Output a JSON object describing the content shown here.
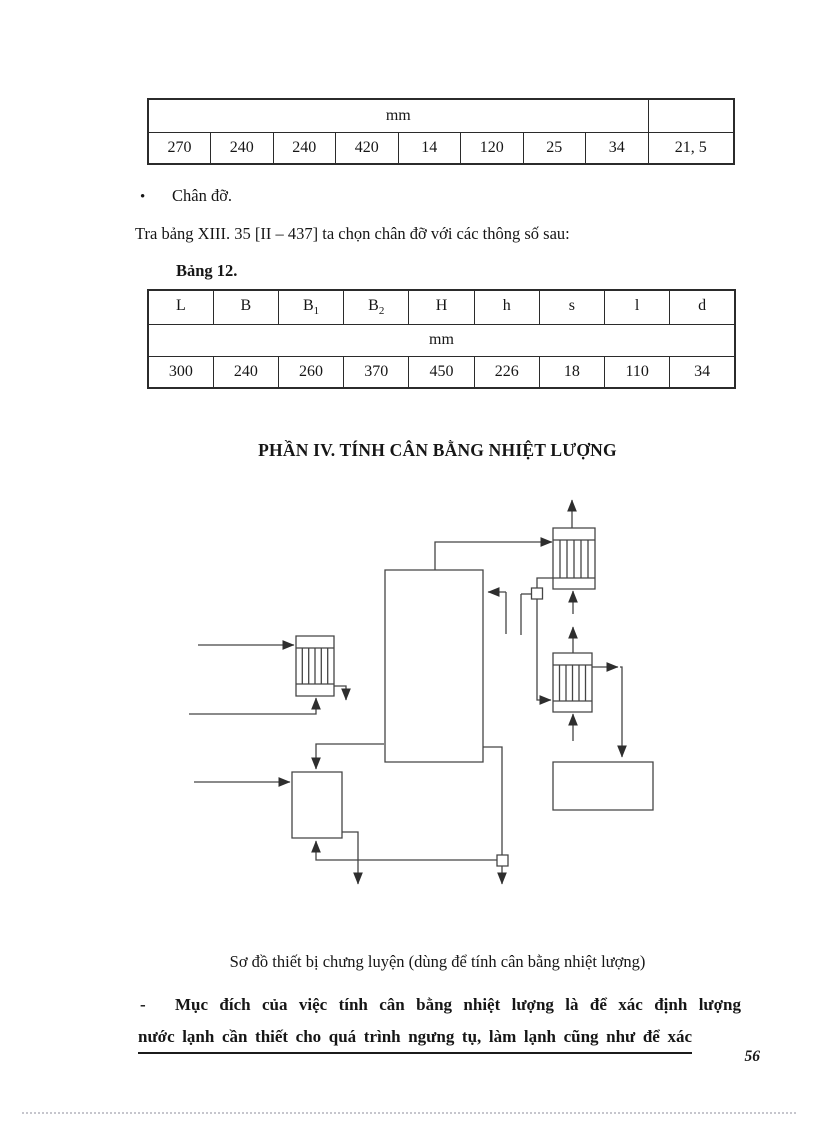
{
  "colors": {
    "ink": "#161616",
    "table_border": "#2b2b2b",
    "diagram_stroke": "#454545"
  },
  "table1": {
    "unit_label": "mm",
    "values": [
      "270",
      "240",
      "240",
      "420",
      "14",
      "120",
      "25",
      "34",
      "21, 5"
    ]
  },
  "bullet": {
    "marker": "•",
    "label": "Chân đỡ."
  },
  "paragraph1": "Tra bảng XIII. 35 [II – 437] ta chọn chân đỡ với các thông số sau:",
  "table2_caption": "Bảng 12.",
  "table2": {
    "headers": [
      {
        "base": "L",
        "sub": ""
      },
      {
        "base": "B",
        "sub": ""
      },
      {
        "base": "B",
        "sub": "1"
      },
      {
        "base": "B",
        "sub": "2"
      },
      {
        "base": "H",
        "sub": ""
      },
      {
        "base": "h",
        "sub": ""
      },
      {
        "base": "s",
        "sub": ""
      },
      {
        "base": "l",
        "sub": ""
      },
      {
        "base": "d",
        "sub": ""
      }
    ],
    "unit_label": "mm",
    "values": [
      "300",
      "240",
      "260",
      "370",
      "450",
      "226",
      "18",
      "110",
      "34"
    ]
  },
  "section_title": "PHẦN IV. TÍNH CÂN BẰNG NHIỆT LƯỢNG",
  "figure": {
    "caption": "Sơ đồ thiết bị chưng luyện (dùng để tính cân bằng nhiệt lượng)"
  },
  "paragraph2": {
    "dash": "-",
    "line1": "Mục đích của việc tính cân bằng nhiệt lượng là để xác định lượng",
    "line2": "nước lạnh cần thiết cho quá trình ngưng tụ, làm lạnh cũng như để xác"
  },
  "page": {
    "number": "56"
  }
}
